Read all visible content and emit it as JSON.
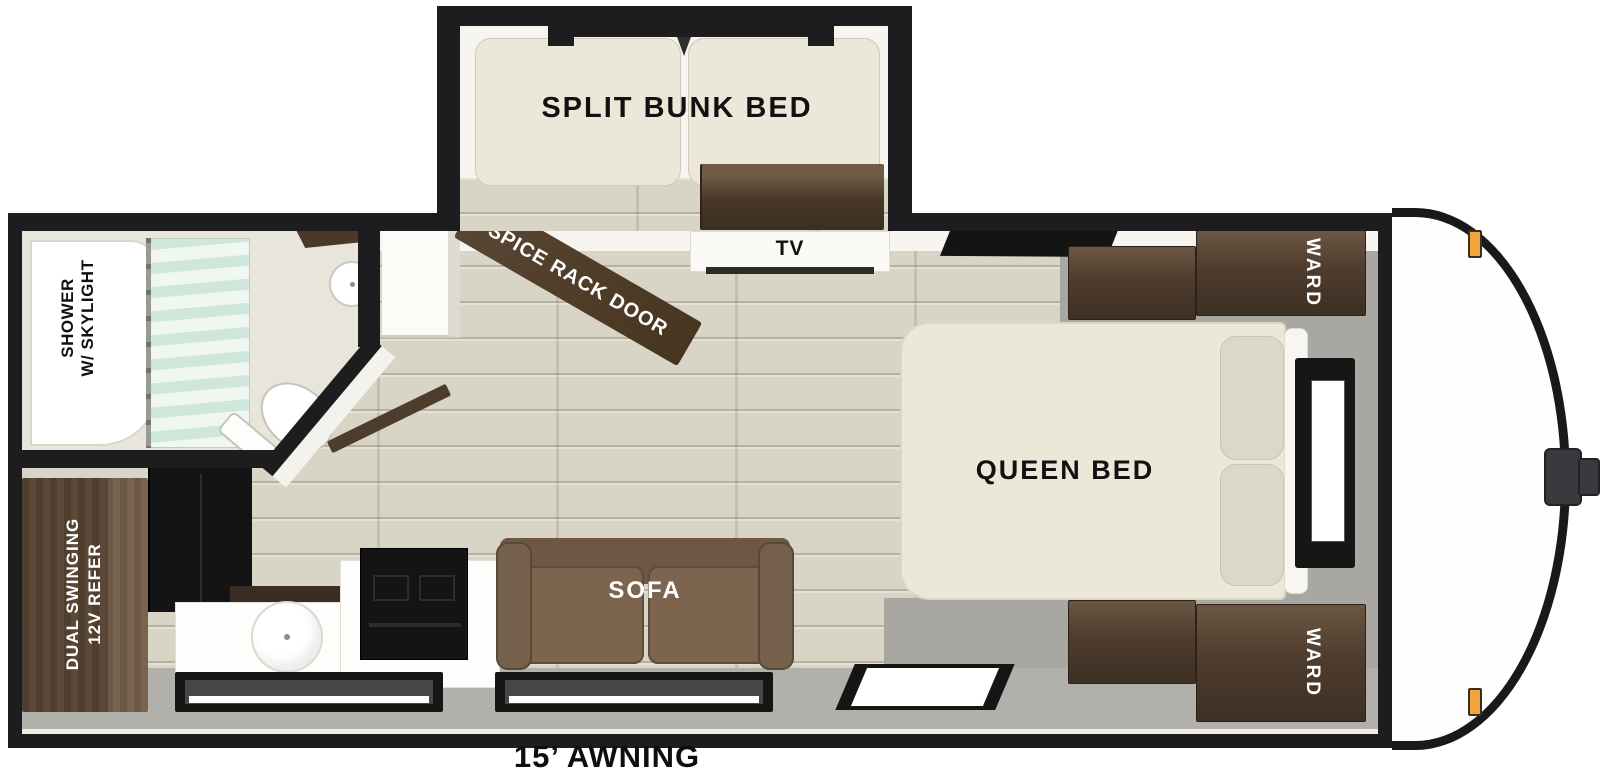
{
  "labels": {
    "split_bunk_bed": "SPLIT BUNK BED",
    "spice_rack_door": "SPICE RACK DOOR",
    "tv": "TV",
    "ward": "WARD",
    "queen_bed": "QUEEN BED",
    "shower_line1": "SHOWER",
    "shower_line2": "W/ SKYLIGHT",
    "refer_line1": "DUAL SWINGING",
    "refer_line2": "12V REFER",
    "sofa": "SOFA",
    "awning": "15’ AWNING"
  },
  "colors": {
    "wall": "#1d1d1f",
    "floor_wood": "#d9d5c6",
    "floor_gray": "#b1b0aa",
    "bedroom_floor": "#a8a7a1",
    "wall_trim": "#f6f5f0",
    "mattress": "#ece8d9",
    "pillow": "#dbd7cb",
    "cabinet_wood": "#4e3c2e",
    "cabinet_wood_light": "#6b5742",
    "fridge_wood": "#63503e",
    "appliance_black": "#141414",
    "sofa_brown": "#6e5844",
    "sofa_cushion": "#7c644e",
    "curtain_mint": "#cfe7da",
    "counter_white": "#fdfdfb",
    "amber": "#f1a43b",
    "cap_white": "#fefefe",
    "text_dark": "#111111",
    "text_light": "#ffffff"
  }
}
